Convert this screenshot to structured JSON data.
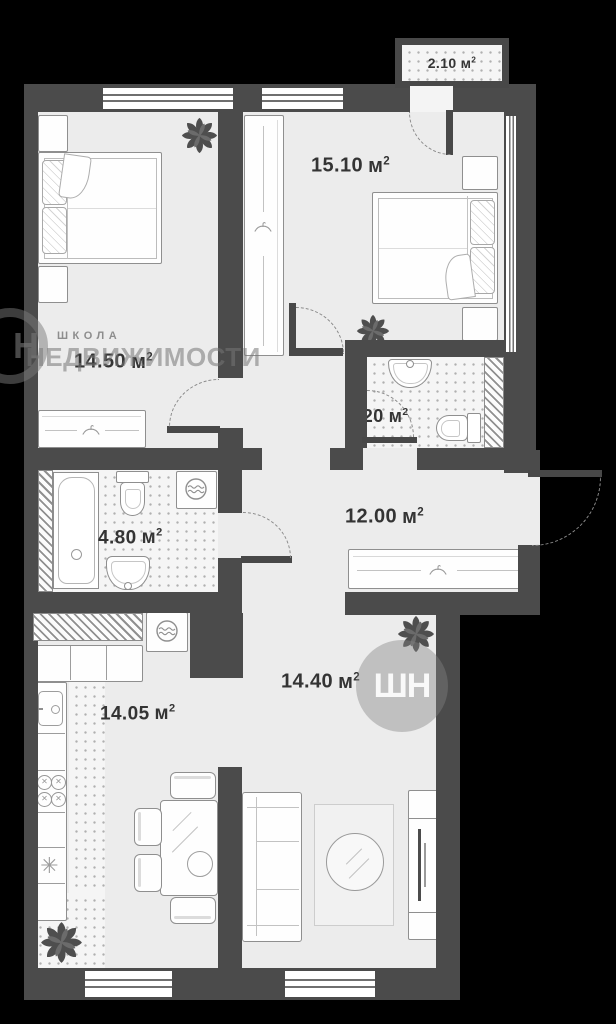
{
  "colors": {
    "background": "#000000",
    "wall": "#4b4b4b",
    "floor": "#ececec",
    "furniture_line": "#8f8f8f",
    "label_text": "#343434",
    "watermark": "#767676"
  },
  "area_unit": {
    "symbol": "м",
    "exponent": "2"
  },
  "rooms": {
    "balcony": {
      "area": "2.10"
    },
    "bedroom_right": {
      "area": "15.10"
    },
    "bedroom_left": {
      "area": "14.50"
    },
    "wc": {
      "area": "3.20"
    },
    "hallway": {
      "area": "12.00"
    },
    "bathroom": {
      "area": "4.80"
    },
    "living_room": {
      "area": "14.40"
    },
    "kitchen": {
      "area": "14.05"
    }
  },
  "watermark": {
    "line_small": "ШКОЛА",
    "line_big": "НЕДВИЖИМОСТИ",
    "logo_text": "ШН",
    "logo_text_partial": "Н"
  },
  "icons": {
    "burner_cross": "✕",
    "corner_star": "✳"
  }
}
